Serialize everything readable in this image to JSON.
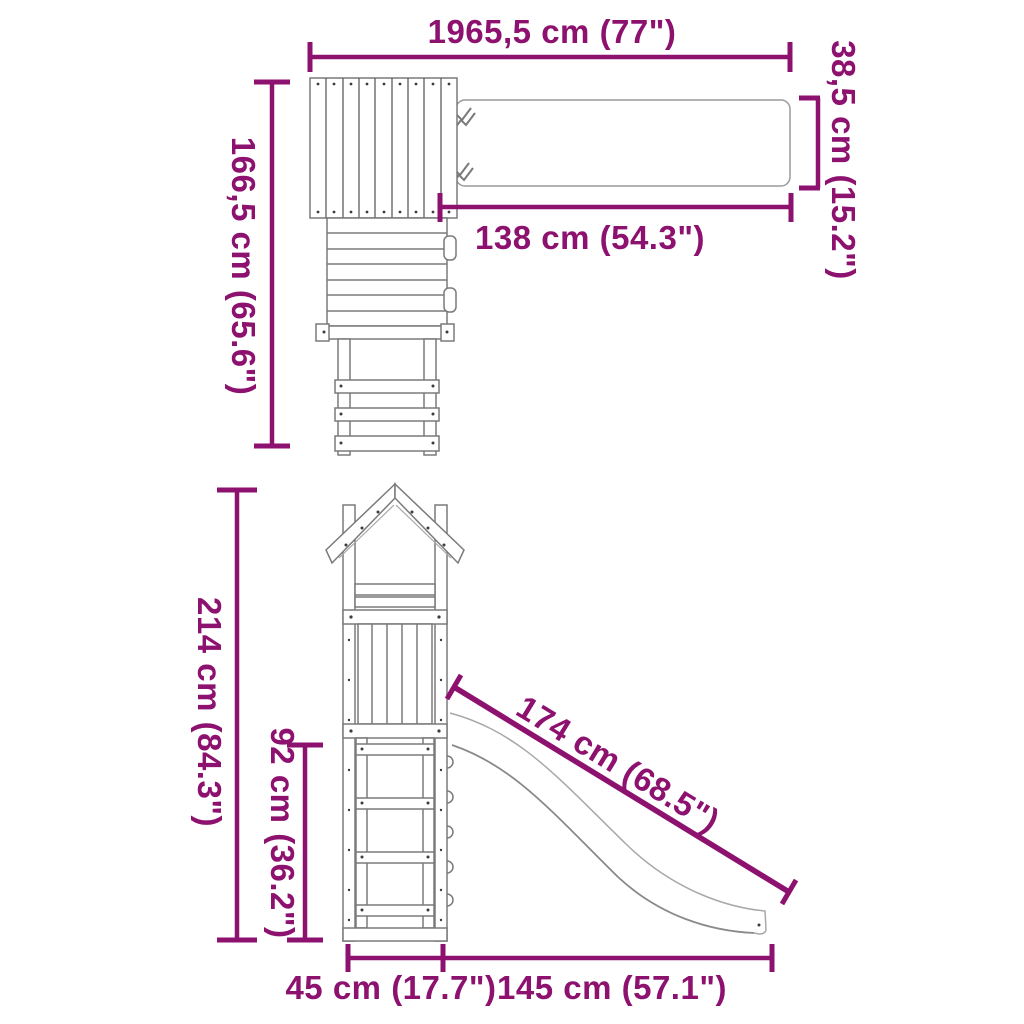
{
  "colors": {
    "dimension_accent": "#8d116e",
    "drawing_outline": "#7a7a7a",
    "background": "#ffffff"
  },
  "plan_view": {
    "overall_width_label": "1965,5 cm (77\")",
    "overall_depth_label": "166,5 cm (65.6\")",
    "beam_length_label": "138 cm (54.3\")",
    "beam_width_label": "38,5 cm (15.2\")"
  },
  "elevation_view": {
    "overall_height_label": "214 cm (84.3\")",
    "platform_height_label": "92 cm (36.2\")",
    "slide_length_label": "174 cm (68.5\")",
    "base_depth_label": "45 cm (17.7\")",
    "slide_run_label": "145 cm (57.1\")"
  }
}
